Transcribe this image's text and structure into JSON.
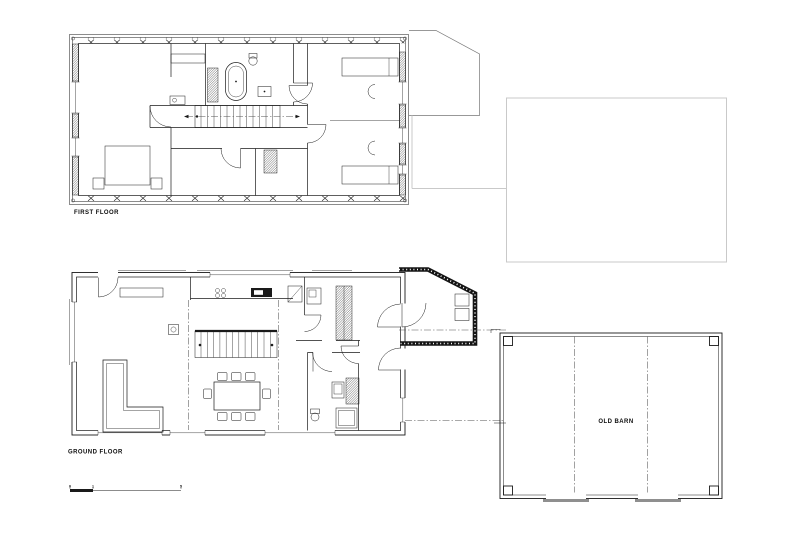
{
  "colors": {
    "paper": "#ffffff",
    "ink": "#1a1a1a",
    "faint": "#c9c9c9",
    "mid_gray": "#8f8f8f",
    "roof_gray": "#777777",
    "dash": "#555555"
  },
  "plans": {
    "first_floor": {
      "label": "FIRST FLOOR"
    },
    "ground_floor": {
      "label": "GROUND FLOOR"
    },
    "old_barn": {
      "label": "OLD BARN"
    }
  },
  "scale_bar": {
    "ticks": [
      "0",
      "1",
      "5"
    ]
  }
}
